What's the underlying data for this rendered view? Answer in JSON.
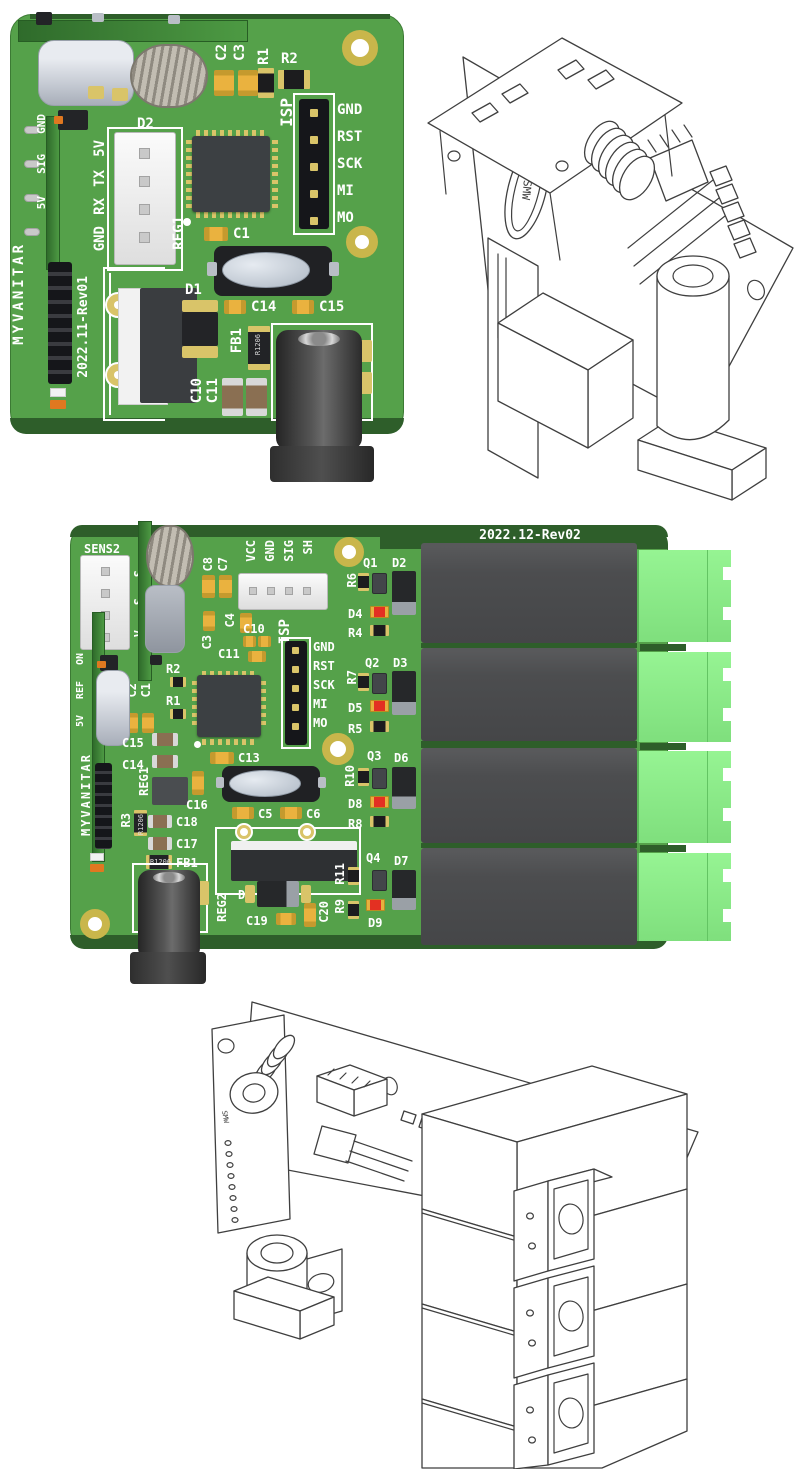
{
  "colors": {
    "pcb_green": "#55a14a",
    "pcb_edge_dark": "#2e5e2a",
    "silkscreen": "#ffffff",
    "pad_gold": "#d9c469",
    "relay_gray": "#4c4d4f",
    "terminal_green": "#8df08b",
    "cap_yellow": "#eab23f",
    "cap_brown": "#8a6f52",
    "led_red": "#e33022",
    "connector_white": "#f2f2f2",
    "crystal_gray": "#b9c2cd",
    "jack_black": "#3a3a3a",
    "wireframe_line": "#3f3f3f"
  },
  "board1": {
    "brand": "MYVANITAR",
    "revision": "2022.11-Rev01",
    "isp": {
      "label": "ISP",
      "pins": [
        "GND",
        "RST",
        "SCK",
        "MI",
        "MO"
      ]
    },
    "serial_pins": [
      "5V",
      "TX",
      "RX",
      "GND"
    ],
    "sensor_pins": [
      "GND",
      "SIG",
      "5V"
    ],
    "refs": {
      "c2": "C2",
      "c3": "C3",
      "r1": "R1",
      "r2": "R2",
      "d2": "D2",
      "reg1": "REG1",
      "c1": "C1",
      "d1": "D1",
      "c14": "C14",
      "c15": "C15",
      "fb1": "FB1",
      "c10": "C10",
      "c11": "C11"
    },
    "fb_marking": "R1206"
  },
  "board2": {
    "brand": "MYVANITAR",
    "revision": "2022.12-Rev02",
    "sens2_label": "SENS2",
    "conn_pins": [
      "VCC",
      "GND",
      "SIG",
      "SH"
    ],
    "side_pins": [
      "ON",
      "REF",
      "5V"
    ],
    "sens2_pin_letters": [
      "S",
      "S",
      "V"
    ],
    "isp": {
      "label": "ISP",
      "pins": [
        "GND",
        "RST",
        "SCK",
        "MI",
        "MO"
      ]
    },
    "refs": {
      "c8": "C8",
      "c7": "C7",
      "c4": "C4",
      "c3": "C3",
      "c10": "C10",
      "c11": "C11",
      "r2": "R2",
      "r1": "R1",
      "c2": "C2",
      "c1": "C1",
      "c15": "C15",
      "c14": "C14",
      "c13": "C13",
      "reg1": "REG1",
      "c16": "C16",
      "c5": "C5",
      "c6": "C6",
      "r3": "R3",
      "c18": "C18",
      "c17": "C17",
      "fb1": "FB1",
      "reg2": "REG2",
      "d1": "D1",
      "c19": "C19",
      "c20": "C20",
      "r6": "R6",
      "q1": "Q1",
      "d2": "D2",
      "d4": "D4",
      "r4": "R4",
      "r7": "R7",
      "q2": "Q2",
      "d3": "D3",
      "d5": "D5",
      "r5": "R5",
      "r10": "R10",
      "q3": "Q3",
      "d6": "D6",
      "d8": "D8",
      "r8": "R8",
      "r11": "R11",
      "q4": "Q4",
      "d7": "D7",
      "r9": "R9",
      "d9": "D9"
    },
    "fb_marking": "R1206"
  },
  "wireframe1": {
    "crystal_marking": "SMW"
  },
  "wireframe2": {
    "crystal_marking": "SMW"
  }
}
